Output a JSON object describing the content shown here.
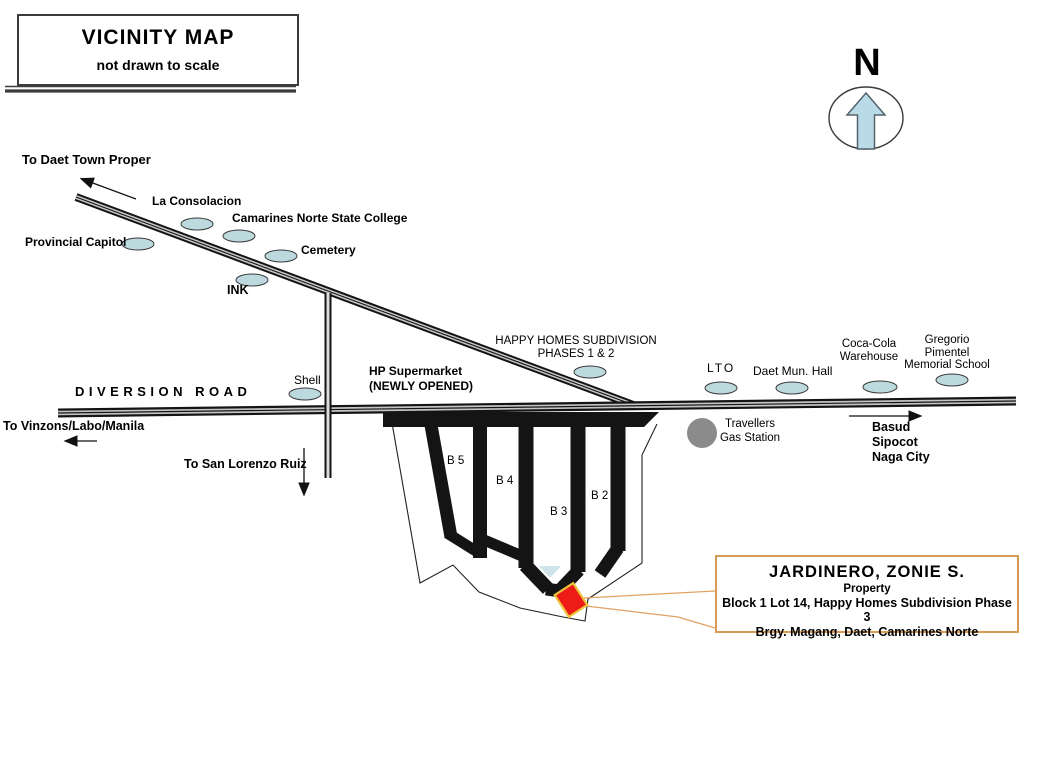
{
  "title_box": {
    "title": "VICINITY MAP",
    "subtitle": "not drawn to scale"
  },
  "compass": {
    "label": "N"
  },
  "roads": {
    "diversion": "DIVERSION ROAD"
  },
  "directions": {
    "daet": "To Daet Town Proper",
    "vinzons": "To Vinzons/Labo/Manila",
    "san_lorenzo": "To San Lorenzo Ruiz",
    "basud_1": "Basud",
    "basud_2": "Sipocot",
    "basud_3": "Naga City"
  },
  "landmarks": {
    "la_consolacion": "La Consolacion",
    "cnsc": "Camarines Norte State College",
    "provincial_capitol": "Provincial Capitol",
    "cemetery": "Cemetery",
    "ink": "INK",
    "shell": "Shell",
    "hp_supermarket_1": "HP Supermarket",
    "hp_supermarket_2": "(NEWLY OPENED)",
    "happy_homes_1": "HAPPY HOMES SUBDIVISION",
    "happy_homes_2": "PHASES 1 & 2",
    "lto": "LTO",
    "daet_hall": "Daet Mun. Hall",
    "coca_cola_1": "Coca-Cola",
    "coca_cola_2": "Warehouse",
    "gregorio_1": "Gregorio",
    "gregorio_2": "Pimentel",
    "gregorio_3": "Memorial School",
    "travellers_1": "Travellers",
    "travellers_2": "Gas Station"
  },
  "subdivision": {
    "blocks": {
      "b5": "B 5",
      "b4": "B 4",
      "b3": "B 3",
      "b2": "B 2"
    }
  },
  "property_box": {
    "owner": "JARDINERO, ZONIE S.",
    "line2": "Property",
    "line3": "Block 1 Lot 14, Happy Homes Subdivision  Phase 3",
    "line4": "Brgy. Magang, Daet, Camarines Norte"
  },
  "colors": {
    "landmark_fill": "#bcd9de",
    "compass_arrow_fill": "#b9dbe7",
    "road_black": "#141414",
    "gas_station_gray": "#8b8b8b",
    "property_red": "#ee1c16",
    "property_marker_border": "#eec33c",
    "callout_tan": "#d89a55"
  }
}
